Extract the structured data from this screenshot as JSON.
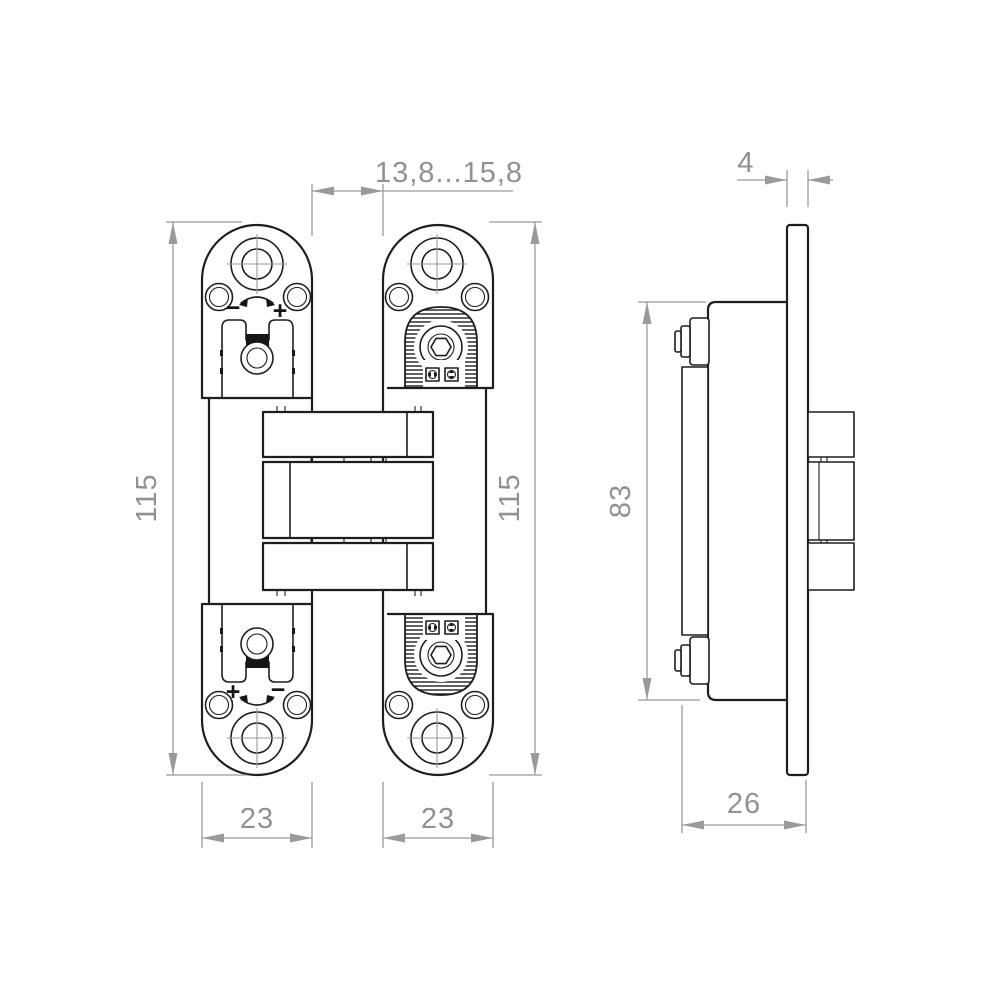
{
  "colors": {
    "line": "#1e1e1e",
    "dimension": "#9a9a9a",
    "dimension_text": "#919191",
    "background": "#ffffff"
  },
  "front_view": {
    "gap_dimension": "13,8...15,8",
    "left_plate": {
      "height": "115",
      "width": "23",
      "top_adjust": {
        "minus": "−",
        "plus": "+"
      },
      "bottom_adjust": {
        "plus": "+",
        "minus": "−"
      }
    },
    "right_plate": {
      "height": "115",
      "width": "23"
    }
  },
  "side_view": {
    "plate_thickness": "4",
    "body_height": "83",
    "depth": "26"
  }
}
